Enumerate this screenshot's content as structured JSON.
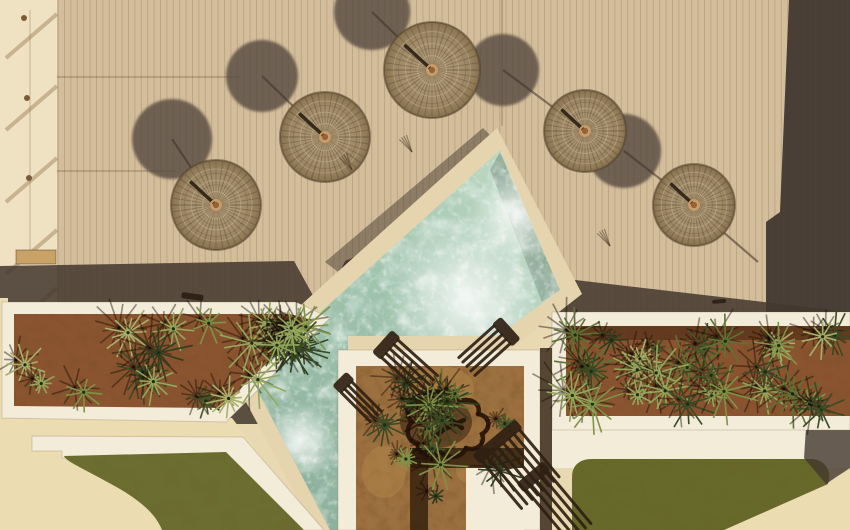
{
  "scene": {
    "description": "Aerial top-down drone view of a resort pool deck: straw parasols on a wooden deck, a diagonal turquoise pool, white-rimmed planters with agaves and palms, lawns and sun loungers. No text or UI controls are visible.",
    "width": 850,
    "height": 530
  },
  "palette": {
    "deck": "#d3bd9b",
    "plank_line": "rgba(120,95,68,0.25)",
    "seam_line": "rgba(100,78,55,0.35)",
    "strip": "#efe2c2",
    "strip_shadow": "rgba(146,112,74,0.42)",
    "post": "#7a5a38",
    "ladder": "#c8a266",
    "shadow_band": "#44382e",
    "right_band": "#362e28",
    "nw_band": "#3a2f26",
    "umbrella_shadow": "#574a3f",
    "pole_line": "rgba(60,50,40,0.55)",
    "coping": "#e6d4ae",
    "water_light": "#bcd8c2",
    "water_mid": "#9fc3ad",
    "water_deep": "#8db19c",
    "water_shade": "rgba(35,60,48,0.25)",
    "white": "#f3ecd9",
    "rim_edge": "rgba(120,100,70,0.25)",
    "soil": "#8a5430",
    "soil_court": "#9c703f",
    "lawn": "#6b6d31",
    "lawn2": "#666929",
    "sand": "#ecdcb2",
    "lounger": "#2f2013",
    "tree": "#261409",
    "umb_edge": "rgba(82,64,42,0.55)",
    "umb_spoke": "rgba(78,60,38,0.32)",
    "umb_ring_light": "rgba(250,240,220,0.22)",
    "umb_knob": "#9a6233",
    "umb_knob_ring": "#c89a67",
    "umb_stick": "rgba(35,25,15,0.85)"
  },
  "deck": {
    "rect": [
      57,
      0,
      793,
      316
    ],
    "plank_pitch": 6.4
  },
  "left_strip": {
    "rect": [
      0,
      0,
      57,
      300
    ],
    "diagonal_shadows": [
      14,
      86,
      158,
      230,
      288
    ],
    "vertical_line_x": 30,
    "posts": [
      [
        24,
        18
      ],
      [
        27,
        98
      ],
      [
        29,
        178
      ],
      [
        31,
        258
      ]
    ],
    "ladder": [
      16,
      250,
      40,
      14
    ]
  },
  "deck_seams": [
    [
      57,
      77,
      240,
      77
    ],
    [
      502,
      0,
      502,
      126
    ],
    [
      57,
      171,
      176,
      171
    ]
  ],
  "shadow_polys": {
    "bottom_band": "0,266 294,261 321,310 345,261 378,247 420,330 420,424 0,424",
    "right_band": "789,0 850,0 850,318 766,318 766,222 780,212",
    "east_sliver": "541,276 850,312 850,318 541,318",
    "pool_nw_band": "325,262 483,128 495,140 338,272"
  },
  "pool": {
    "coping": "497,128 582,294 505,354 338,354 338,530 314,530 229,370",
    "water": "500,150 560,290 498,336 348,336 348,530 330,530 250,376",
    "ne_inner_shadow": "500,152 560,290 542,302 490,170",
    "sw_inner_shadow": "250,376 330,530 312,530 250,396",
    "foam_spots": [
      [
        468,
        300,
        85
      ],
      [
        420,
        415,
        55
      ],
      [
        515,
        215,
        45
      ],
      [
        300,
        440,
        38
      ]
    ]
  },
  "sand": {
    "bottom_left": "0,298 8,298 8,418 232,418 318,530 0,530",
    "bottom_right": "M724,530 L828,484 C838,478 845,473 850,470 L850,530 Z"
  },
  "paths_white": {
    "left_path": "32,436 243,437 324,530 294,530 227,456 62,458 62,451 32,451",
    "right_path": [
      552,
      428,
      298,
      40
    ]
  },
  "lawns": {
    "left": "M64,456 L226,452 L304,530 L162,530 C152,504 118,488 100,478 C78,466 66,461 64,456 Z",
    "right": "M592,459 L812,459 C826,460 832,472 828,484 C812,505 768,522 724,530 L572,530 L572,477 C572,465 580,459 592,459 Z",
    "corner_shadow": "M806,428 L850,428 L850,468 C844,472 836,477 826,484 L804,458 Z"
  },
  "planters": {
    "left": {
      "outer": "2,302 296,302 330,318 226,422 2,418",
      "inner": "14,314 290,314 312,320 220,408 14,406",
      "areas": [
        [
          20,
          320,
          262,
          82
        ],
        [
          268,
          324,
          38,
          36
        ]
      ],
      "count": 26,
      "seed": 3
    },
    "right": {
      "outer": "552,312 850,312 850,430 552,430",
      "inner": "566,326 850,326 850,416 566,416",
      "areas": [
        [
          572,
          330,
          270,
          80
        ]
      ],
      "count": 30,
      "seed": 7,
      "rim_shadow": [
        566,
        326,
        284,
        14
      ]
    },
    "courtyard": {
      "outer": [
        338,
        350,
        202,
        180
      ],
      "inner": [
        356,
        366,
        168,
        164
      ],
      "areas": [
        [
          362,
          372,
          154,
          140
        ]
      ],
      "count": 15,
      "seed": 12,
      "pad": [
        466,
        468,
        58,
        62
      ],
      "pad_shadow": [
        [
          410,
          448,
          114,
          20
        ],
        [
          410,
          448,
          18,
          82
        ]
      ],
      "gap_strip": [
        540,
        348,
        12,
        182
      ],
      "light_patches": [
        [
          440,
          388,
          34,
          22
        ],
        [
          478,
          470,
          22,
          16
        ],
        [
          384,
          472,
          22,
          26
        ]
      ]
    }
  },
  "tree": {
    "shadow": [
      436,
      422,
      36,
      26
    ],
    "strokes": [
      "M415,398 C430,388 452,390 458,402 C470,396 482,404 478,414",
      "M478,414 C490,416 492,428 482,434 C486,444 476,452 466,448",
      "M466,448 C462,458 448,460 440,452 C430,460 416,454 418,444",
      "M418,444 C408,442 404,430 412,422 C404,414 408,402 415,398",
      "M430,408 C440,416 452,418 462,428",
      "M436,436 C444,428 456,424 464,420"
    ]
  },
  "umbrellas": [
    {
      "cx": 216,
      "cy": 205,
      "r": 45
    },
    {
      "cx": 325,
      "cy": 137,
      "r": 45
    },
    {
      "cx": 432,
      "cy": 70,
      "r": 48
    },
    {
      "cx": 585,
      "cy": 131,
      "r": 41
    },
    {
      "cx": 694,
      "cy": 205,
      "r": 41
    }
  ],
  "umbrella_shadows": [
    {
      "cx": 172,
      "cy": 139,
      "r": 40
    },
    {
      "cx": 262,
      "cy": 76,
      "r": 36
    },
    {
      "cx": 372,
      "cy": 12,
      "r": 38
    },
    {
      "cx": 503,
      "cy": 70,
      "r": 36
    },
    {
      "cx": 624,
      "cy": 151,
      "r": 37
    }
  ],
  "pole_shadow_lines": [
    [
      172,
      139,
      216,
      205
    ],
    [
      262,
      76,
      325,
      137
    ],
    [
      372,
      12,
      432,
      70
    ],
    [
      503,
      70,
      585,
      131
    ],
    [
      624,
      151,
      694,
      205
    ],
    [
      700,
      212,
      758,
      262
    ]
  ],
  "loungers": [
    {
      "x": 352,
      "y": 380,
      "angle": 45,
      "slats": 4,
      "len": 44,
      "gap": 5
    },
    {
      "x": 398,
      "y": 338,
      "angle": 42,
      "slats": 5,
      "len": 56,
      "gap": 6
    },
    {
      "x": 512,
      "y": 344,
      "angle": 138,
      "slats": 5,
      "len": 50,
      "gap": 6
    },
    {
      "x": 520,
      "y": 428,
      "angle": 50,
      "slats": 8,
      "len": 64,
      "gap": 7
    },
    {
      "x": 548,
      "y": 470,
      "angle": 50,
      "slats": 5,
      "len": 70,
      "gap": 7
    }
  ],
  "misc_marks": [
    {
      "x": 182,
      "y": 292,
      "w": 22,
      "h": 6,
      "rot": 8
    },
    {
      "x": 712,
      "y": 300,
      "w": 14,
      "h": 4,
      "rot": -5
    }
  ],
  "grass_tufts": [
    [
      352,
      170
    ],
    [
      610,
      246
    ],
    [
      412,
      152
    ]
  ],
  "plant_palette": [
    "#2e3d1f",
    "#44552a",
    "#5d7334",
    "#7d9448",
    "#93a85c",
    "#394a25",
    "#a8b06a"
  ]
}
